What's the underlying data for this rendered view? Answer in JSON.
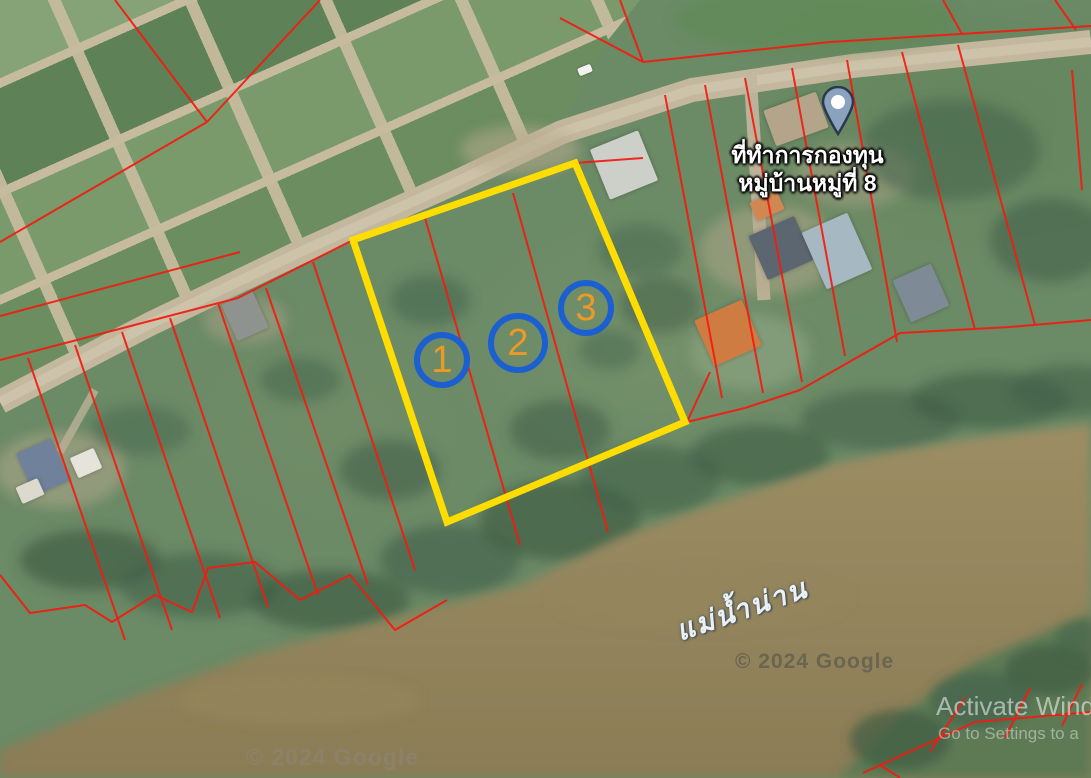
{
  "map": {
    "office_label": {
      "line1": "ที่ทำการกองทุน",
      "line2": "หมู่บ้านหมู่ที่ 8"
    },
    "river_label": "แม่น้ำน่าน",
    "markers": [
      {
        "number": "1"
      },
      {
        "number": "2"
      },
      {
        "number": "3"
      }
    ],
    "watermarks": {
      "river": "© 2024 Google",
      "shore": "© 2024 Google"
    },
    "colors": {
      "parcel_boundary_red": "#f31b10",
      "highlight_parcel_yellow": "#ffdd00",
      "marker_ring_blue": "#1b5fd0",
      "marker_number_orange": "#eb9a28",
      "river_brown": "#8e805a",
      "vegetation_green": "#6b8a66",
      "road_tan": "#c3b79e",
      "pin_fill": "#8aa2bd"
    }
  },
  "system_overlay": {
    "activate_line1": "Activate Wind",
    "activate_line2": "Go to Settings to a"
  }
}
